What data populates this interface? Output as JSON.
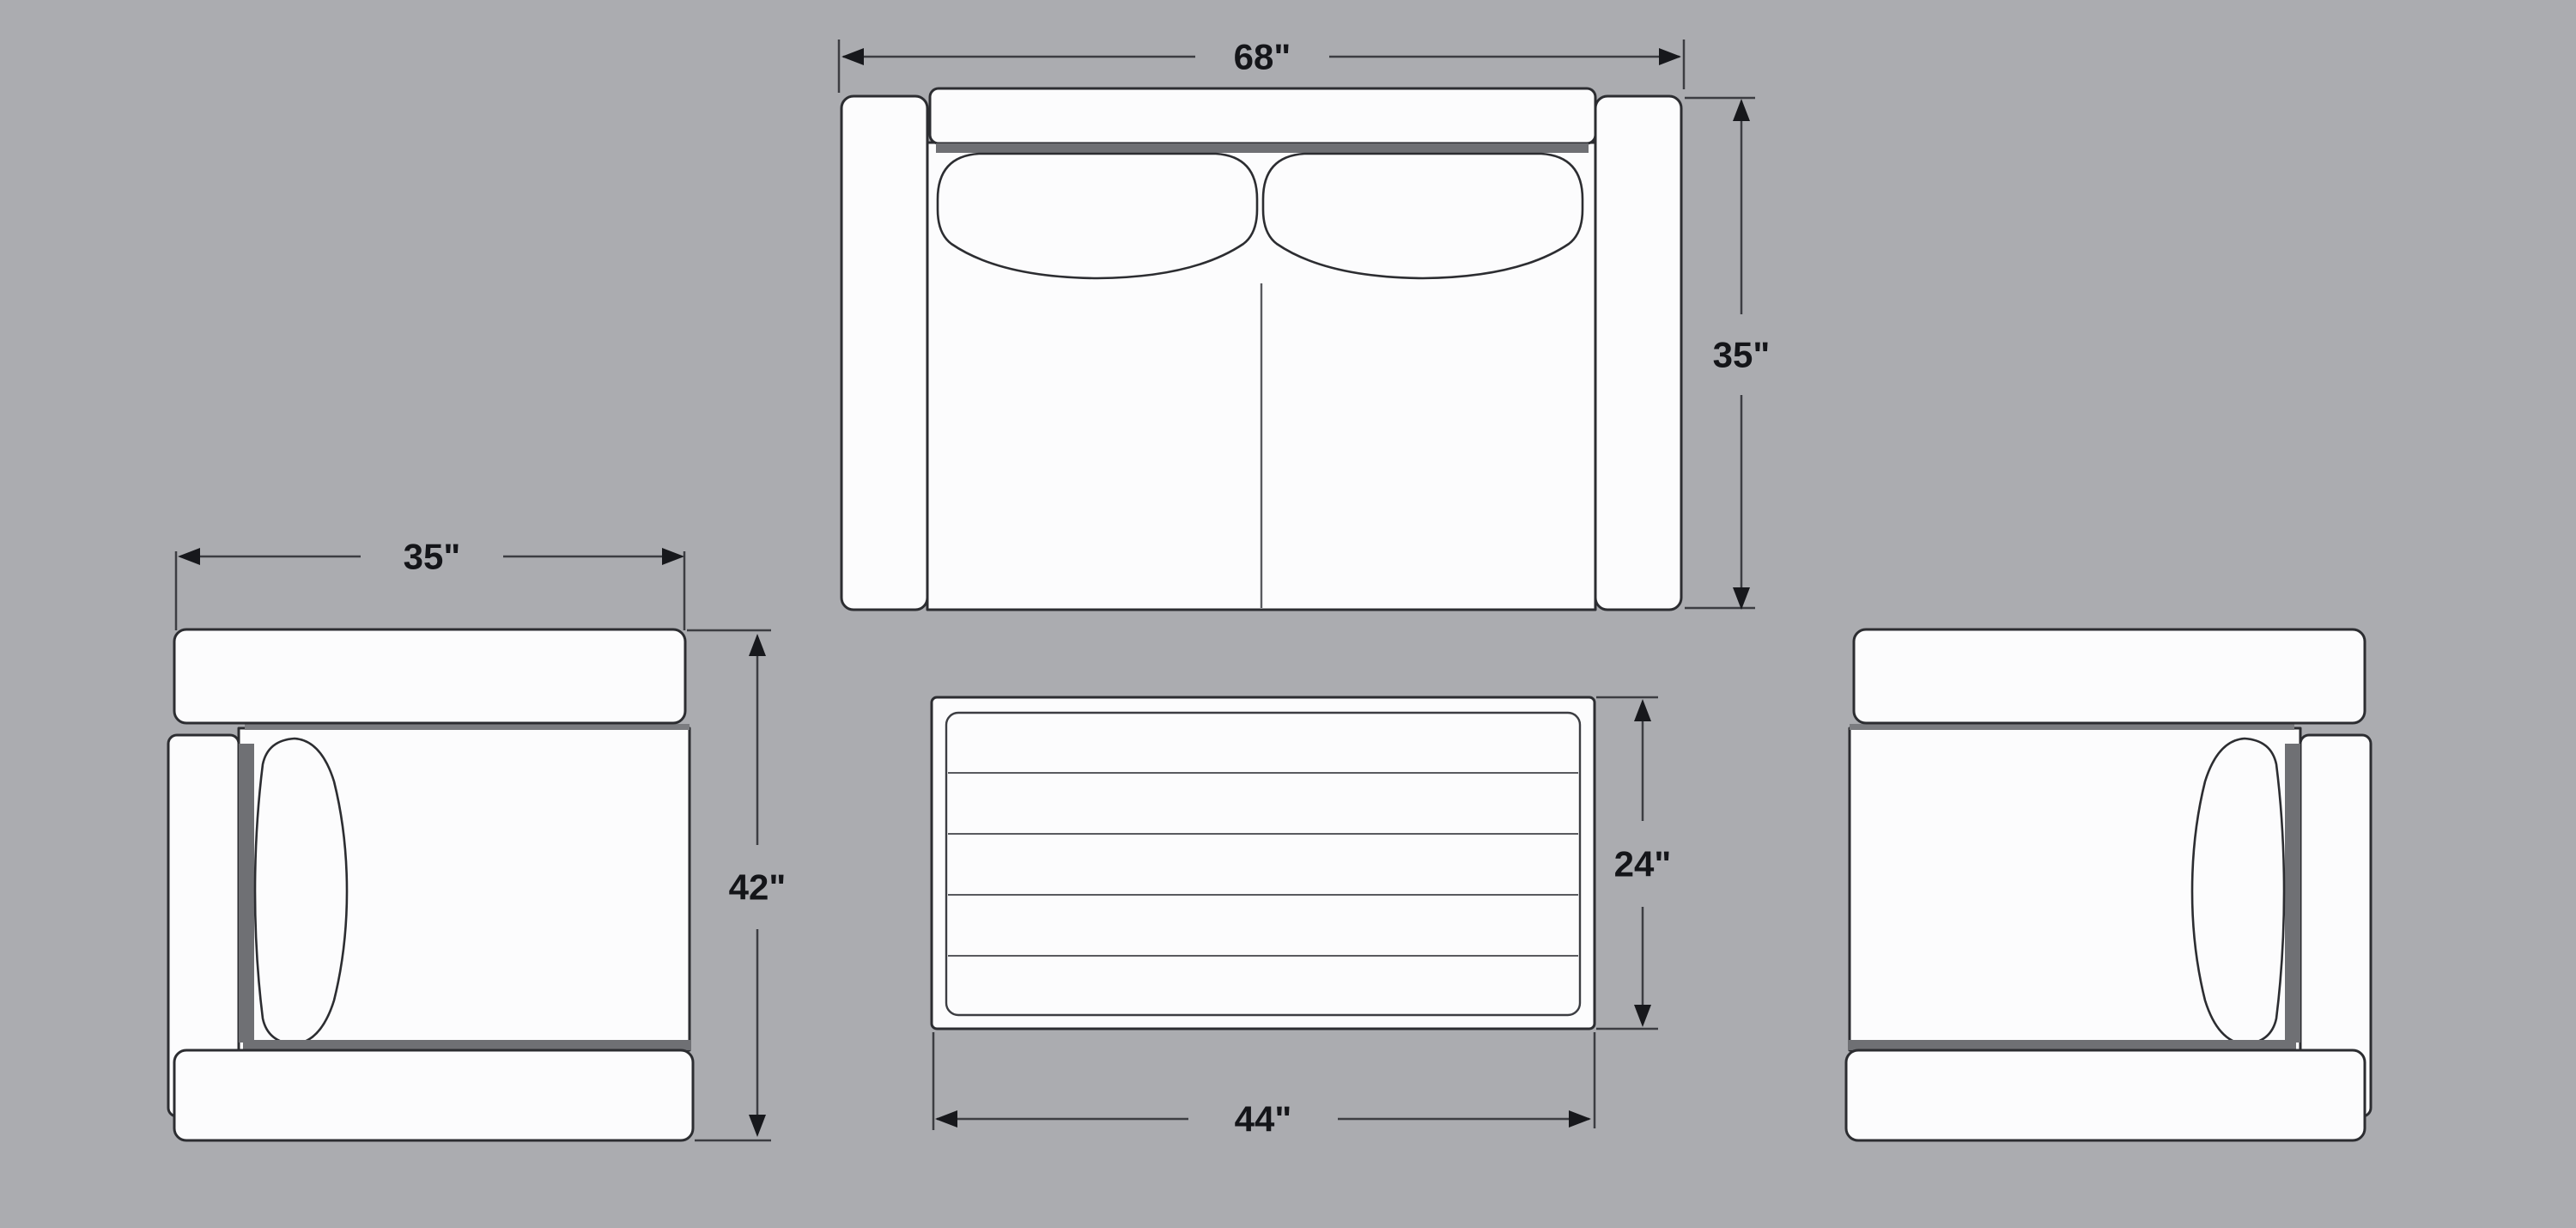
{
  "page": {
    "title": "Furniture Top-View Dimension Diagram"
  },
  "colors": {
    "background": "#abacb0",
    "furniture_fill": "#fcfcfd",
    "outline": "#2c2d31",
    "detail_line": "#595a5f",
    "seam_shadow": "#6f7074",
    "dimension_line": "#3c3d42",
    "label_text": "#141519"
  },
  "labels": {
    "sofa_width": "68\"",
    "sofa_depth": "35\"",
    "chair_width": "35\"",
    "chair_depth": "42\"",
    "table_depth": "24\"",
    "table_width": "44\""
  },
  "furniture": {
    "sofa": {
      "name": "loveseat sofa top view",
      "width": "68\"",
      "depth": "35\""
    },
    "armchair_left": {
      "name": "armchair top view",
      "width": "35\"",
      "depth": "42\""
    },
    "coffee_table": {
      "name": "coffee table top view",
      "width": "44\"",
      "depth": "24\""
    },
    "armchair_right": {
      "name": "armchair top view",
      "width": "35\"",
      "depth": "42\""
    }
  }
}
